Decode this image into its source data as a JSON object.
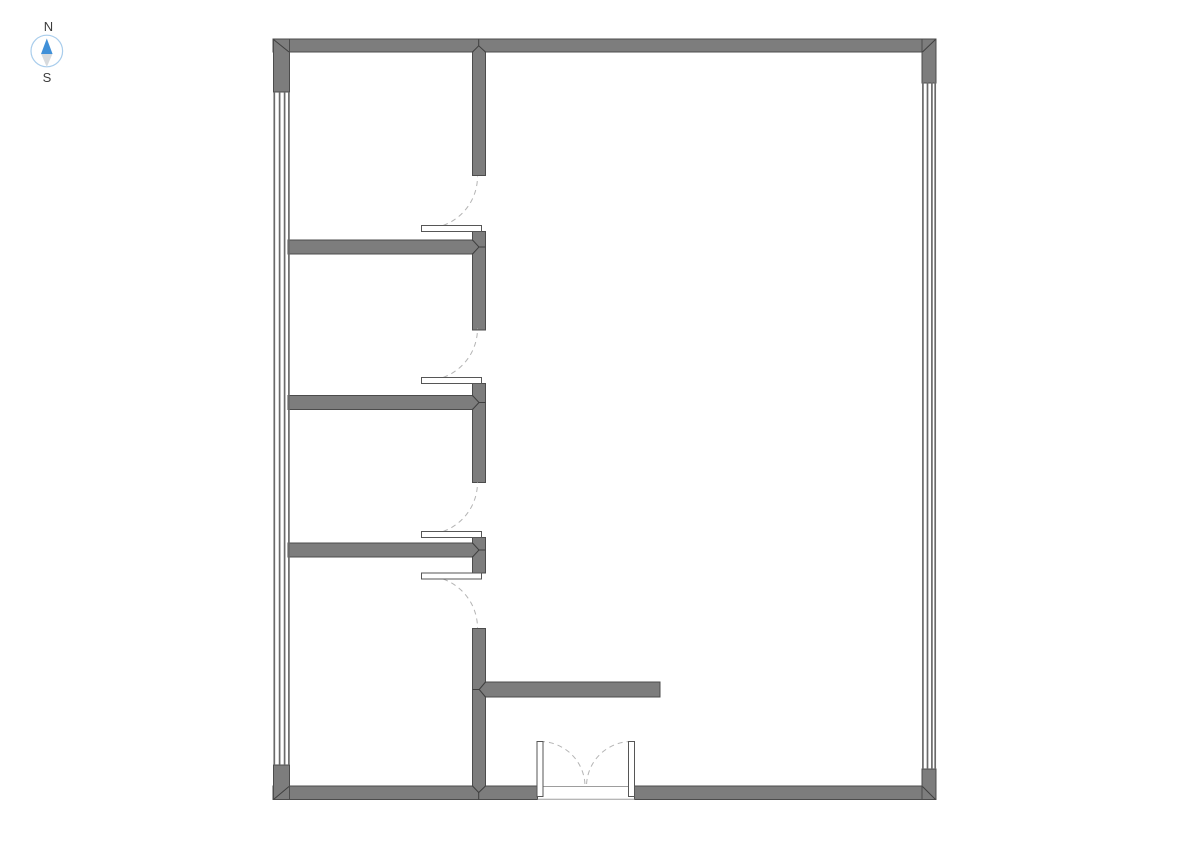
{
  "compass": {
    "north_label": "N",
    "south_label": "S",
    "label_color": "#3d3d3d",
    "ring_color": "#a9cdec",
    "needle_north_color": "#4090d8",
    "needle_south_color": "#d7dadd"
  },
  "floorplan": {
    "colors": {
      "background": "#ffffff",
      "wall_fill": "#7d7d7d",
      "wall_stroke": "#4c4c4c",
      "joint_line": "#3f3f3f",
      "window_line": "#6a6a6a",
      "door_leaf_fill": "#ffffff",
      "door_leaf_stroke": "#565656",
      "door_arc": "#b4b4b4",
      "threshold": "#9d9d9d"
    },
    "arc_dash": "5 4",
    "walls": [
      {
        "name": "wall-exterior-top",
        "x": 273,
        "y": 39,
        "w": 663,
        "h": 13
      },
      {
        "name": "wall-exterior-bottom-left",
        "x": 273,
        "y": 786,
        "w": 264.5,
        "h": 13.5
      },
      {
        "name": "wall-exterior-bottom-right",
        "x": 634.5,
        "y": 786,
        "w": 301.5,
        "h": 13.5
      },
      {
        "name": "wall-pier-left-top",
        "x": 273.5,
        "y": 39,
        "w": 16,
        "h": 53
      },
      {
        "name": "wall-pier-left-bottom",
        "x": 273.5,
        "y": 765,
        "w": 16,
        "h": 34.5
      },
      {
        "name": "wall-pier-right-top",
        "x": 922,
        "y": 39,
        "w": 14,
        "h": 44
      },
      {
        "name": "wall-pier-right-bottom",
        "x": 922,
        "y": 769,
        "w": 14,
        "h": 30.5
      },
      {
        "name": "wall-interior-horizontal-1",
        "x": 288,
        "y": 240,
        "w": 184.5,
        "h": 14
      },
      {
        "name": "wall-interior-horizontal-2",
        "x": 288,
        "y": 395.5,
        "w": 184.5,
        "h": 14
      },
      {
        "name": "wall-interior-horizontal-3",
        "x": 288,
        "y": 543,
        "w": 184.5,
        "h": 14
      },
      {
        "name": "wall-interior-vertical-1",
        "x": 472.5,
        "y": 52,
        "w": 13,
        "h": 123.5
      },
      {
        "name": "wall-interior-vertical-2",
        "x": 472.5,
        "y": 231.5,
        "w": 13,
        "h": 98.5
      },
      {
        "name": "wall-interior-vertical-3",
        "x": 472.5,
        "y": 383.5,
        "w": 13,
        "h": 99
      },
      {
        "name": "wall-interior-vertical-4",
        "x": 472.5,
        "y": 537.5,
        "w": 13,
        "h": 35.5
      },
      {
        "name": "wall-interior-vertical-5",
        "x": 472.5,
        "y": 628.5,
        "w": 13,
        "h": 157.5
      },
      {
        "name": "wall-interior-stub",
        "x": 485.5,
        "y": 682,
        "w": 174.5,
        "h": 15
      },
      {
        "name": "wall-join-patch-top",
        "x": 473.2,
        "y": 51.3,
        "w": 11.6,
        "h": 1.4,
        "join": true
      },
      {
        "name": "wall-join-patch-bottom",
        "x": 473.2,
        "y": 785.3,
        "w": 11.6,
        "h": 1.4,
        "join": true
      },
      {
        "name": "wall-join-patch-tee-1",
        "x": 471.8,
        "y": 240.7,
        "w": 1.4,
        "h": 12.6,
        "join": true
      },
      {
        "name": "wall-join-patch-tee-2",
        "x": 471.8,
        "y": 396.2,
        "w": 1.4,
        "h": 12.6,
        "join": true
      },
      {
        "name": "wall-join-patch-tee-3",
        "x": 471.8,
        "y": 543.7,
        "w": 1.4,
        "h": 12.6,
        "join": true
      },
      {
        "name": "wall-join-patch-stub",
        "x": 484.8,
        "y": 682.7,
        "w": 1.4,
        "h": 13.6,
        "join": true
      }
    ],
    "windows": [
      {
        "name": "window-left",
        "x_centers": [
          274.3,
          279.6,
          284.6,
          288.9
        ],
        "y1": 92,
        "y2": 765,
        "line_width": 1.7
      },
      {
        "name": "window-right",
        "x_centers": [
          922.9,
          927.5,
          931.9,
          935.2
        ],
        "y1": 82.5,
        "y2": 769,
        "line_width": 1.7
      }
    ],
    "joints": [
      {
        "name": "miter-corner-top-left",
        "points": [
          [
            273.5,
            39.5
          ],
          [
            289,
            52
          ]
        ]
      },
      {
        "name": "miter-corner-top-right",
        "points": [
          [
            935.5,
            39.5
          ],
          [
            922.5,
            52
          ]
        ]
      },
      {
        "name": "miter-corner-bottom-left",
        "points": [
          [
            273.5,
            799.5
          ],
          [
            289,
            786.5
          ]
        ]
      },
      {
        "name": "miter-corner-bottom-right",
        "points": [
          [
            935.5,
            799.5
          ],
          [
            922.5,
            786.5
          ]
        ]
      },
      {
        "name": "joint-top-chevron",
        "points": [
          [
            472.5,
            52
          ],
          [
            478.7,
            45.8
          ],
          [
            485.5,
            52
          ]
        ]
      },
      {
        "name": "joint-top-stem",
        "points": [
          [
            478.7,
            45.8
          ],
          [
            478.7,
            39.5
          ]
        ]
      },
      {
        "name": "joint-tee-1-chevron",
        "points": [
          [
            472.5,
            240
          ],
          [
            479,
            247
          ],
          [
            472.5,
            254
          ]
        ]
      },
      {
        "name": "joint-tee-1-stem",
        "points": [
          [
            479,
            247
          ],
          [
            485.5,
            247
          ]
        ]
      },
      {
        "name": "joint-tee-2-chevron",
        "points": [
          [
            472.5,
            395.5
          ],
          [
            479,
            402.5
          ],
          [
            472.5,
            409.5
          ]
        ]
      },
      {
        "name": "joint-tee-2-stem",
        "points": [
          [
            479,
            402.5
          ],
          [
            485.5,
            402.5
          ]
        ]
      },
      {
        "name": "joint-tee-3-chevron",
        "points": [
          [
            472.5,
            543
          ],
          [
            479,
            550
          ],
          [
            472.5,
            557
          ]
        ]
      },
      {
        "name": "joint-tee-3-stem",
        "points": [
          [
            479,
            550
          ],
          [
            485.5,
            550
          ]
        ]
      },
      {
        "name": "joint-bottom-chevron",
        "points": [
          [
            472.5,
            786
          ],
          [
            478.7,
            792.5
          ],
          [
            485.5,
            786
          ]
        ]
      },
      {
        "name": "joint-bottom-stem",
        "points": [
          [
            478.7,
            792.5
          ],
          [
            478.7,
            799.5
          ]
        ]
      },
      {
        "name": "joint-stub-chevron",
        "points": [
          [
            485.5,
            682
          ],
          [
            479.2,
            689.5
          ],
          [
            485.5,
            697
          ]
        ]
      },
      {
        "name": "joint-stub-stem",
        "points": [
          [
            479.2,
            689.5
          ],
          [
            472.5,
            689.5
          ]
        ]
      }
    ],
    "thresholds": [
      {
        "name": "entrance-threshold-inner",
        "x1": 543.5,
        "y1": 786.5,
        "x2": 628,
        "y2": 786.5
      },
      {
        "name": "entrance-threshold-outer",
        "x1": 537.5,
        "y1": 799.2,
        "x2": 634.5,
        "y2": 799.2
      }
    ],
    "doors": [
      {
        "name": "door-room-1",
        "leaf": {
          "x": 421.5,
          "y": 225.5,
          "w": 60,
          "h": 6
        },
        "arc": "M 425.5 228.5 A 52 52 0 0 0 477.5 176.5"
      },
      {
        "name": "door-room-2",
        "leaf": {
          "x": 421.5,
          "y": 377.5,
          "w": 60,
          "h": 6
        },
        "arc": "M 425.5 380.5 A 52 52 0 0 0 477.5 328.5"
      },
      {
        "name": "door-room-3",
        "leaf": {
          "x": 421.5,
          "y": 531.5,
          "w": 60,
          "h": 6
        },
        "arc": "M 425.5 534.5 A 52 52 0 0 0 477.5 482.5"
      },
      {
        "name": "door-room-4",
        "leaf": {
          "x": 421.5,
          "y": 573,
          "w": 60,
          "h": 6
        },
        "arc": "M 425.5 576 A 52 52 0 0 1 477.5 628"
      },
      {
        "name": "entrance-door-left",
        "leaf": {
          "x": 537,
          "y": 741.5,
          "w": 6,
          "h": 55
        },
        "arc": "M 540 741.5 A 45 45 0 0 1 585 786.5"
      },
      {
        "name": "entrance-door-right",
        "leaf": {
          "x": 628.5,
          "y": 741.5,
          "w": 6,
          "h": 55
        },
        "arc": "M 631.5 741.5 A 45 45 0 0 0 586.5 786.5"
      }
    ]
  }
}
